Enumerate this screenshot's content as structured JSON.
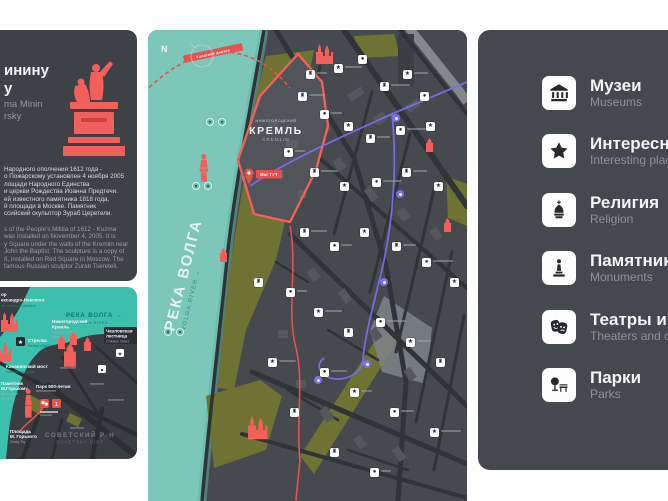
{
  "colors": {
    "panel": "#404448",
    "red": "#f2605c",
    "route_red": "#e8514d",
    "water_mini": "#3dbfae",
    "water_main": "#7cc6ba",
    "olive": "#6e7233",
    "purple": "#7b6ff0",
    "tile_bg": "#fdfdfd"
  },
  "info_card": {
    "title_ru": [
      "инину",
      "у"
    ],
    "title_en": [
      "ma Minin",
      "rsky"
    ],
    "body_ru": [
      "Народного ополчения 1612 года -",
      "о Пожарскому установлен 4 ноября 2005",
      "лощади Народного Единства",
      "и церкви Рождества Иоанна Предтечи.",
      "ей известного памятника 1818 года,",
      "й площади в Москве. Памятник",
      "ссийский скульптор Зураб Церетели."
    ],
    "body_en": [
      "s of the People's Militia of 1612 - Kuzma",
      "was installed on November 4, 2005. It is",
      "y Square under the walls of the Kremlin near",
      "John the Baptist. The sculpture is a copy of",
      "8, installed on Red Square in Moscow. The",
      "famous Russian sculptor Zurab Tsereteli."
    ]
  },
  "mini_map": {
    "river_ru": "РЕКА ВОЛГА →",
    "river_en": "VOLGA RIVER",
    "cathedral_ru1": "ор",
    "cathedral_ru2": "ександро-Невского",
    "cathedral_en": "der Nevsky Cathedral",
    "strelka_ru": "Стрелка",
    "strelka_en": "Strelka (Spit)",
    "bridge_ru": "Канавинский мост",
    "bridge_en": "Kanavinsky bridge",
    "kremlin_ru1": "Нижегородский",
    "kremlin_ru2": "Кремль",
    "kremlin_en1": "Nizhegorodsky",
    "kremlin_en2": "Kremlin",
    "stairs_ru1": "Чкаловская",
    "stairs_ru2": "лестница",
    "stairs_en": "Chkalov Stairs",
    "park800_ru": "Парк 800-летия",
    "gorky_mon_ru1": "Памятник",
    "gorky_mon_ru2": "М.Горькому",
    "gorky_mon_en1": "Monument",
    "gorky_mon_en2": "M.Gorky",
    "gorky_sq_ru1": "Площадь",
    "gorky_sq_ru2": "М. Горького",
    "gorky_sq_en": "Gorky Sq",
    "stop_number": "1",
    "district_ru": "СОВЕТСКИЙ Р-Н",
    "district_en": "SOVETSKY DIST"
  },
  "main_map": {
    "compass": "N",
    "river_ru": "РЕКА ВОЛГА",
    "river_en": "VOLGA RIVER →",
    "kremlin_small": "НИЖЕГОРОДСКИЙ",
    "kremlin_ru": "КРЕМЛЬ",
    "kremlin_en": "KREMLIN",
    "you_here": "ВЫ ТУТ",
    "cable_banner": "Канатная дорога",
    "glyphs": {
      "s": "★",
      "f": "♜",
      "d": "●",
      "t": "▲",
      "p": "+"
    },
    "markers": [
      [
        158,
        40,
        "f"
      ],
      [
        186,
        34,
        "s"
      ],
      [
        210,
        25,
        "d"
      ],
      [
        232,
        52,
        "f"
      ],
      [
        255,
        40,
        "s"
      ],
      [
        272,
        62,
        "d"
      ],
      [
        150,
        62,
        "f"
      ],
      [
        172,
        80,
        "d"
      ],
      [
        196,
        92,
        "s"
      ],
      [
        218,
        104,
        "f"
      ],
      [
        248,
        96,
        "d"
      ],
      [
        278,
        92,
        "s"
      ],
      [
        136,
        118,
        "d"
      ],
      [
        162,
        138,
        "f"
      ],
      [
        192,
        152,
        "s"
      ],
      [
        224,
        148,
        "d"
      ],
      [
        254,
        138,
        "f"
      ],
      [
        286,
        152,
        "s"
      ],
      [
        152,
        198,
        "f"
      ],
      [
        182,
        212,
        "d"
      ],
      [
        212,
        198,
        "s"
      ],
      [
        244,
        212,
        "f"
      ],
      [
        274,
        228,
        "d"
      ],
      [
        302,
        248,
        "s"
      ],
      [
        138,
        258,
        "d"
      ],
      [
        166,
        278,
        "s"
      ],
      [
        196,
        298,
        "f"
      ],
      [
        228,
        288,
        "d"
      ],
      [
        258,
        308,
        "s"
      ],
      [
        288,
        328,
        "f"
      ],
      [
        172,
        338,
        "d"
      ],
      [
        202,
        358,
        "s"
      ],
      [
        142,
        378,
        "f"
      ],
      [
        242,
        378,
        "d"
      ],
      [
        282,
        398,
        "s"
      ],
      [
        182,
        418,
        "f"
      ],
      [
        222,
        438,
        "d"
      ],
      [
        120,
        328,
        "s"
      ],
      [
        106,
        248,
        "f"
      ]
    ],
    "pylons": [
      [
        58,
        88
      ],
      [
        70,
        88
      ],
      [
        44,
        152
      ],
      [
        56,
        152
      ],
      [
        16,
        298
      ],
      [
        28,
        298
      ]
    ],
    "purple_stops": [
      [
        244,
        84
      ],
      [
        248,
        160
      ],
      [
        232,
        248
      ],
      [
        215,
        330
      ],
      [
        166,
        346
      ]
    ]
  },
  "legend": {
    "items": [
      {
        "ru": "Музеи",
        "en": "Museums",
        "icon": "museum"
      },
      {
        "ru": "Интересные места",
        "en": "Interesting places",
        "icon": "star"
      },
      {
        "ru": "Религия",
        "en": "Religion",
        "icon": "church"
      },
      {
        "ru": "Памятники",
        "en": "Monuments",
        "icon": "monument"
      },
      {
        "ru": "Театры и кино",
        "en": "Theaters and cinemas",
        "icon": "theater"
      },
      {
        "ru": "Парки",
        "en": "Parks",
        "icon": "park"
      }
    ]
  }
}
